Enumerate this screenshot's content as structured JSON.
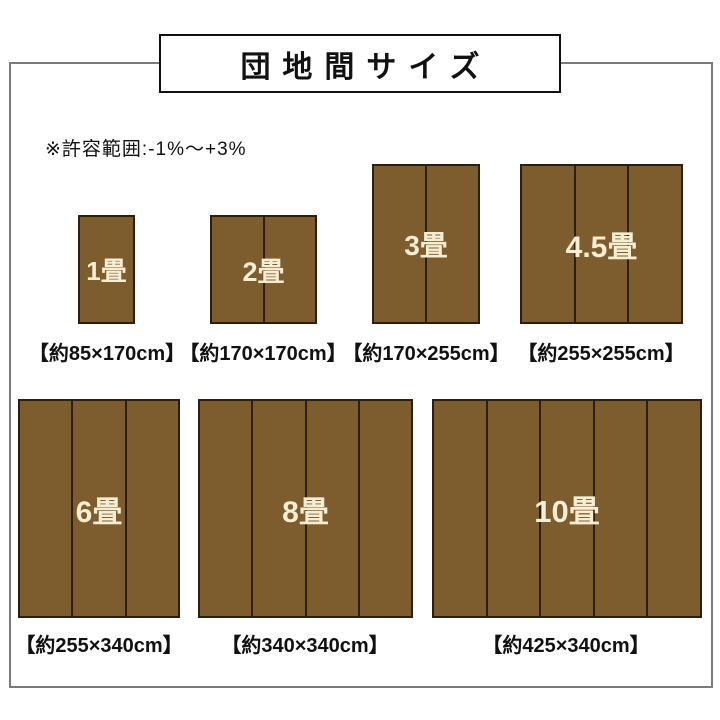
{
  "title": "団地間サイズ",
  "note": "※許容範囲:-1%〜+3%",
  "colors": {
    "mat_fill": "#7d5c2e",
    "mat_border": "#2b1f12",
    "mat_label": "#f6eed3",
    "frame_border": "#7b7b7b",
    "title_border": "#111111",
    "text": "#111111"
  },
  "mats": [
    {
      "name": "1畳",
      "size_label": "【約85×170cm】",
      "panels": 1
    },
    {
      "name": "2畳",
      "size_label": "【約170×170cm】",
      "panels": 2
    },
    {
      "name": "3畳",
      "size_label": "【約170×255cm】",
      "panels": 2
    },
    {
      "name": "4.5畳",
      "size_label": "【約255×255cm】",
      "panels": 3
    },
    {
      "name": "6畳",
      "size_label": "【約255×340cm】",
      "panels": 3
    },
    {
      "name": "8畳",
      "size_label": "【約340×340cm】",
      "panels": 4
    },
    {
      "name": "10畳",
      "size_label": "【約425×340cm】",
      "panels": 5
    }
  ]
}
